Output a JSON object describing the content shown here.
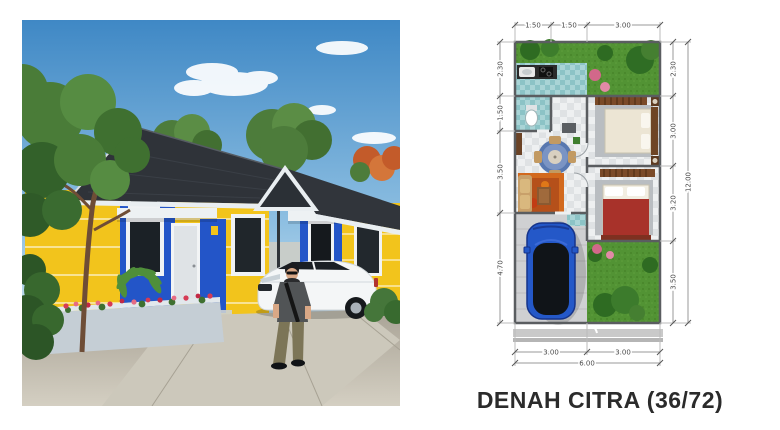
{
  "left_panel": {
    "description": "3D exterior rendering of two attached one-storey houses with yellow walls, blue accent pillars, dark shingle roofs, white canopies, a white sedan parked in the carport, a man in grey t-shirt and olive pants walking on the street, tropical trees and a planter of red flowers",
    "colors": {
      "sky_top": "#3f88c5",
      "sky_horizon": "#d6e8f2",
      "wall_yellow": "#f2c41c",
      "accent_blue": "#2355c8",
      "roof_dark": "#2f3339",
      "trim_white": "#e9eef1",
      "road": "#c2bcae"
    }
  },
  "floor_plan": {
    "caption": "DENAH CITRA (36/72)",
    "dim_top": [
      "1.50",
      "1.50",
      "3.00"
    ],
    "dim_left": [
      "2.30",
      "1.50",
      "3.50",
      "4.70"
    ],
    "dim_right": [
      "2.30",
      "3.00",
      "3.20",
      "3.50"
    ],
    "dim_right_total": "12.00",
    "dim_bottom": [
      "3.00",
      "3.00"
    ],
    "dim_bottom_total": "6.00",
    "rooms_depicted": [
      "rear garden",
      "kitchen",
      "bathroom",
      "dining area",
      "living area",
      "bedroom 1",
      "bedroom 2",
      "carport with blue car",
      "front garden"
    ],
    "colors": {
      "grass": "#529334",
      "tile_teal": "#8cc3c6",
      "floor_grey": "#dfe2e4",
      "car_blue": "#2458c8",
      "bed_blanket_red": "#a8322a",
      "rug_orange": "#d2691e",
      "dim_line": "#9a9a9a"
    }
  }
}
